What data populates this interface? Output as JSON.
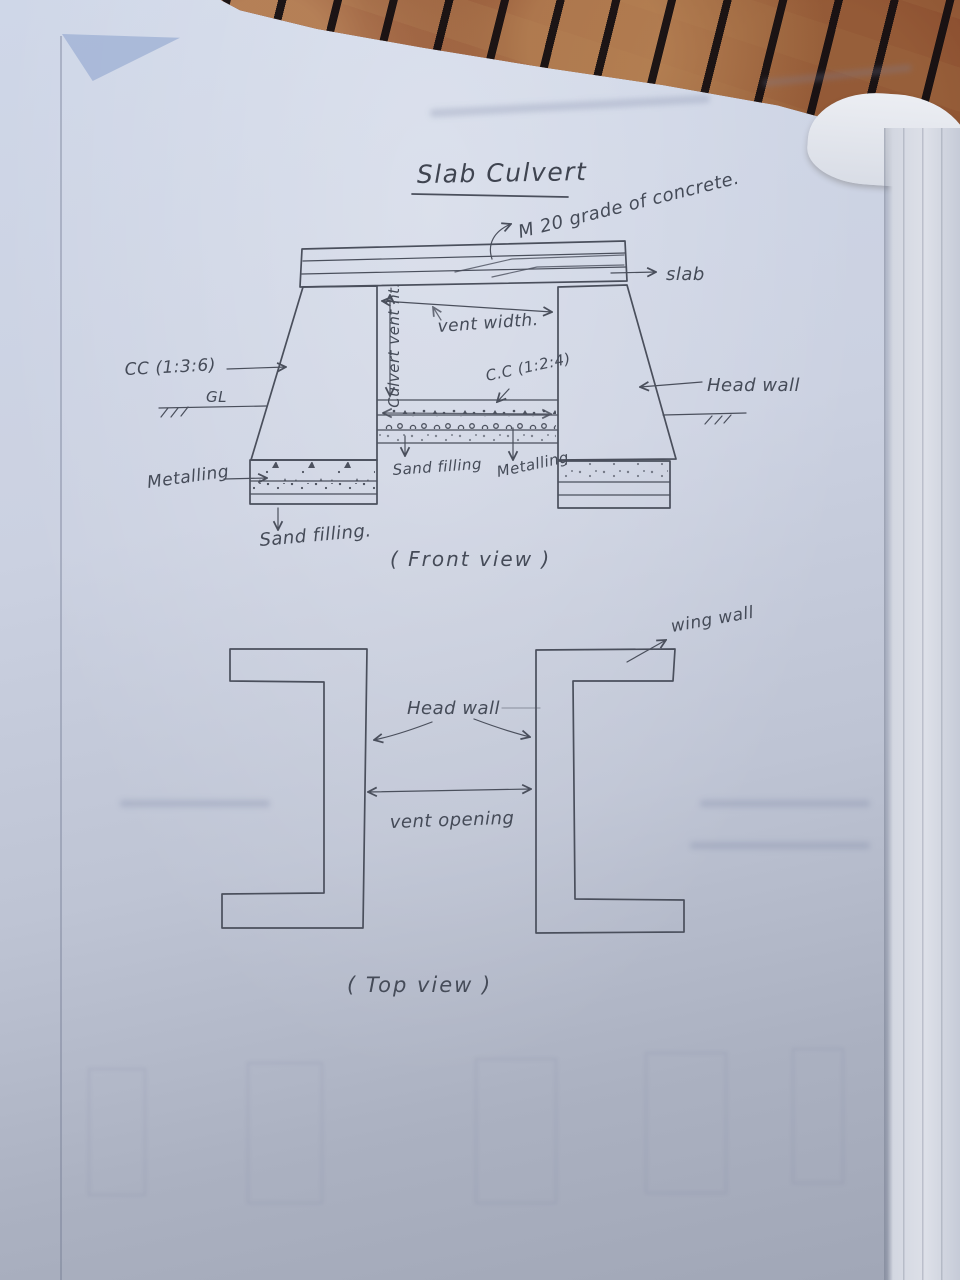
{
  "title": {
    "text": "Slab Culvert"
  },
  "front_view": {
    "caption": "( Front view )",
    "labels": {
      "concrete_grade": "M 20 grade of concrete.",
      "slab": "slab",
      "vent_width": "vent width.",
      "culvert_vent_height": "Culvert vent ht.",
      "cc_1_3_6": "CC (1:3:6)",
      "ground_level": "GL",
      "cc_1_2_4": "C.C (1:2:4)",
      "head_wall": "Head wall",
      "metalling_left": "Metalling",
      "sand_filling_center": "Sand filling",
      "metalling_center": "Metalling",
      "sand_filling_bottom": "Sand filling."
    }
  },
  "top_view": {
    "caption": "( Top view )",
    "labels": {
      "wing_wall": "wing wall",
      "head_wall": "Head wall",
      "vent_opening": "vent opening"
    }
  },
  "colors": {
    "pencil": "#4a4f5c",
    "paper": "#c9cfdf",
    "carpet": "#82452b"
  }
}
